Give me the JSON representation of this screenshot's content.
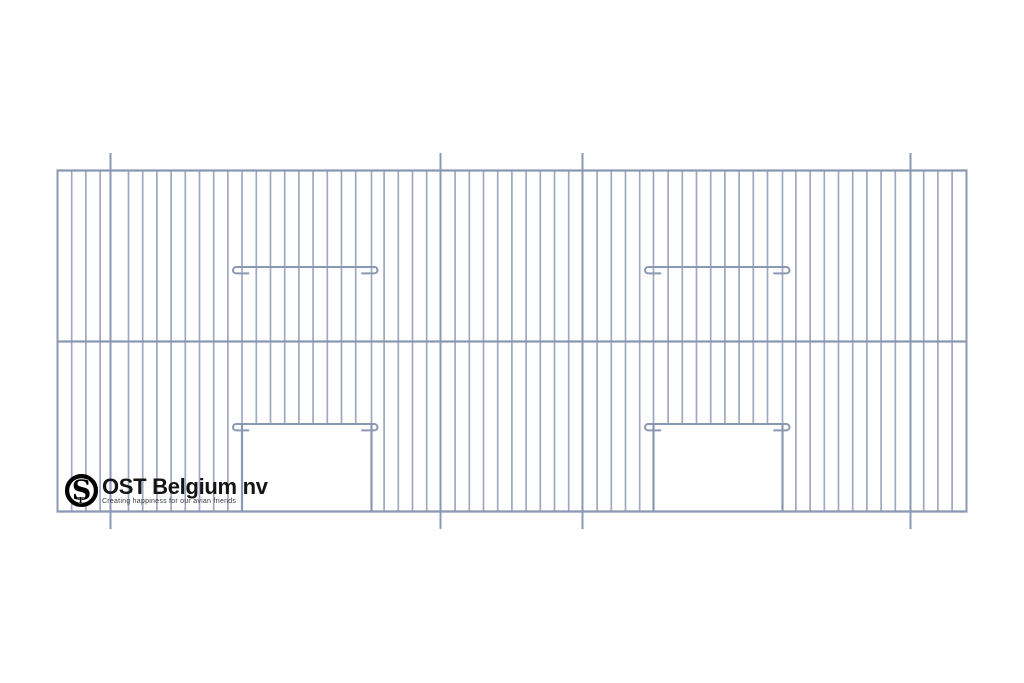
{
  "page": {
    "background": "#ffffff"
  },
  "logo": {
    "brand": "OST Belgium nv",
    "tagline": "Creating happiness for our avian friends",
    "monogram_s": "S",
    "monogram_t": "T",
    "ring_color": "#000000",
    "text_color": "#141414"
  },
  "drawing": {
    "width": 1024,
    "height": 683,
    "colors": {
      "wire": "#9ea9c1",
      "strong": "#8b98b4",
      "background": "#ffffff"
    },
    "panel": {
      "left": 57.5,
      "right": 966.5,
      "top": 170.5,
      "bottom": 511.5,
      "mid_y": 341.5
    },
    "pitch": 14.2,
    "wire_width": 1.7,
    "rail_width": 2.2,
    "frame_width": 2.2,
    "supports": {
      "xs": [
        110.5,
        440.5,
        582.5,
        910.5
      ],
      "overhang": 17.5,
      "width": 2
    },
    "slots": {
      "y": 267,
      "spans": [
        [
          233,
          377.5
        ],
        [
          645,
          789.5
        ]
      ],
      "hook_radius": 3.2,
      "stub_length": 13,
      "width": 2
    },
    "doors": {
      "top_y": 424,
      "hook_spans": [
        [
          233,
          377.5
        ],
        [
          645,
          789.5
        ]
      ],
      "openings": [
        [
          242,
          371.5
        ],
        [
          653.5,
          782.5
        ]
      ]
    }
  }
}
